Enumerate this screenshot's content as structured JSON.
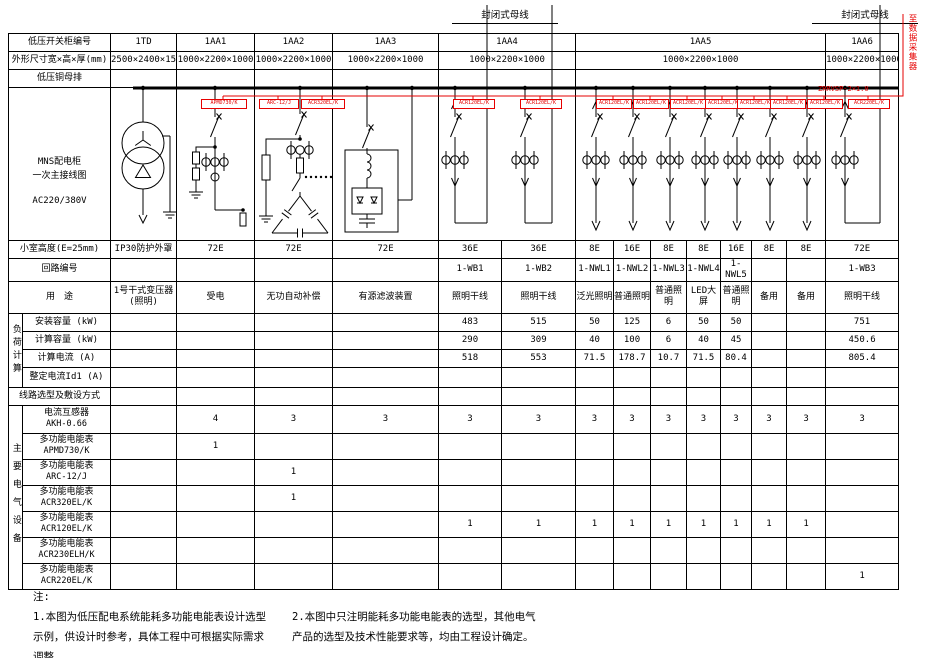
{
  "header": {
    "cabinet_row_label": "低压开关柜编号",
    "cabinets": [
      "1TD",
      "1AA1",
      "1AA2",
      "1AA3",
      "1AA4",
      "1AA5",
      "1AA6"
    ],
    "dim_row_label": "外形尺寸宽×高×厚(mm)",
    "dims": [
      "2500×2400×1500",
      "1000×2200×1000",
      "1000×2200×1000",
      "1000×2200×1000",
      "1000×2200×1000",
      "1000×2200×1000",
      "1000×2200×1000"
    ],
    "busbar_row_label": "低压铜母排"
  },
  "diagram": {
    "title1": "MNS配电柜",
    "title2": "一次主接线图",
    "voltage": "AC220/380V",
    "bus_duct_mid": "封闭式母线",
    "bus_duct_right": "封闭式母线",
    "collector": "至数据采集器",
    "collector_cable": "ZRRVSP-2×1.0",
    "meters": [
      "APMD730/K",
      "ARC-12/J",
      "ACR320EL/K",
      "ACR120EL/K",
      "ACR120EL/K",
      "ACR120EL/K",
      "ACR120EL/K",
      "ACR120EL/K",
      "ACR120EL/K",
      "ACR120EL/K",
      "ACR120EL/K",
      "ACR120EL/K",
      "ACR220EL/K"
    ]
  },
  "groups": {
    "load_calc": "负荷计算",
    "equipment": "主要电气设备"
  },
  "rows": {
    "cell_height": {
      "label": "小室高度(E=25mm)",
      "values": [
        "IP30防护外罩",
        "72E",
        "72E",
        "72E",
        "36E",
        "36E",
        "8E",
        "16E",
        "8E",
        "8E",
        "16E",
        "8E",
        "8E",
        "72E"
      ]
    },
    "circuit_no": {
      "label": "回路编号",
      "values": [
        "",
        "",
        "",
        "",
        "1-WB1",
        "1-WB2",
        "1-NWL1",
        "1-NWL2",
        "1-NWL3",
        "1-NWL4",
        "1-NWL5",
        "",
        "",
        "1-WB3"
      ]
    },
    "usage": {
      "label": "用　途",
      "values": [
        "1号干式变压器(照明)",
        "受电",
        "无功自动补偿",
        "有源滤波装置",
        "照明干线",
        "照明干线",
        "泛光照明",
        "普通照明",
        "普通照明",
        "LED大屏",
        "普通照明",
        "备用",
        "备用",
        "照明干线"
      ]
    },
    "install_cap": {
      "label": "安装容量 (kW)",
      "values": [
        "",
        "",
        "",
        "",
        "483",
        "515",
        "50",
        "125",
        "6",
        "50",
        "50",
        "",
        "",
        "751"
      ]
    },
    "calc_cap": {
      "label": "计算容量 (kW)",
      "values": [
        "",
        "",
        "",
        "",
        "290",
        "309",
        "40",
        "100",
        "6",
        "40",
        "45",
        "",
        "",
        "450.6"
      ]
    },
    "calc_cur": {
      "label": "计算电流 (A)",
      "values": [
        "",
        "",
        "",
        "",
        "518",
        "553",
        "71.5",
        "178.7",
        "10.7",
        "71.5",
        "80.4",
        "",
        "",
        "805.4"
      ]
    },
    "set_cur": {
      "label": "整定电流Id1 (A)",
      "values": [
        "",
        "",
        "",
        "",
        "",
        "",
        "",
        "",
        "",
        "",
        "",
        "",
        "",
        ""
      ]
    },
    "line_sel": {
      "label": "线路选型及敷设方式",
      "values": [
        "",
        "",
        "",
        "",
        "",
        "",
        "",
        "",
        "",
        "",
        "",
        "",
        "",
        ""
      ]
    },
    "ct": {
      "label": "电流互感器",
      "model": "AKH-0.66",
      "values": [
        "",
        "4",
        "3",
        "3",
        "3",
        "3",
        "3",
        "3",
        "3",
        "3",
        "3",
        "3",
        "3",
        "3"
      ]
    },
    "m1": {
      "label": "多功能电能表",
      "model": "APMD730/K",
      "values": [
        "",
        "1",
        "",
        "",
        "",
        "",
        "",
        "",
        "",
        "",
        "",
        "",
        "",
        ""
      ]
    },
    "m2": {
      "label": "多功能电能表",
      "model": "ARC-12/J",
      "values": [
        "",
        "",
        "1",
        "",
        "",
        "",
        "",
        "",
        "",
        "",
        "",
        "",
        "",
        ""
      ]
    },
    "m3": {
      "label": "多功能电能表",
      "model": "ACR320EL/K",
      "values": [
        "",
        "",
        "1",
        "",
        "",
        "",
        "",
        "",
        "",
        "",
        "",
        "",
        "",
        ""
      ]
    },
    "m4": {
      "label": "多功能电能表",
      "model": "ACR120EL/K",
      "values": [
        "",
        "",
        "",
        "",
        "1",
        "1",
        "1",
        "1",
        "1",
        "1",
        "1",
        "1",
        "1",
        ""
      ]
    },
    "m5": {
      "label": "多功能电能表",
      "model": "ACR230ELH/K",
      "values": [
        "",
        "",
        "",
        "",
        "",
        "",
        "",
        "",
        "",
        "",
        "",
        "",
        "",
        ""
      ]
    },
    "m6": {
      "label": "多功能电能表",
      "model": "ACR220EL/K",
      "values": [
        "",
        "",
        "",
        "",
        "",
        "",
        "",
        "",
        "",
        "",
        "",
        "",
        "",
        "1"
      ]
    }
  },
  "notes": {
    "title": "注:",
    "n1": "1.本图为低压配电系统能耗多功能电能表设计选型示例，供设计时参考，具体工程中可根据实际需求调整。",
    "n2": "2.本图中只注明能耗多功能电能表的选型，其他电气产品的选型及技术性能要求等，均由工程设计确定。"
  },
  "colors": {
    "accent_red": "#e60000",
    "line_black": "#000000"
  }
}
